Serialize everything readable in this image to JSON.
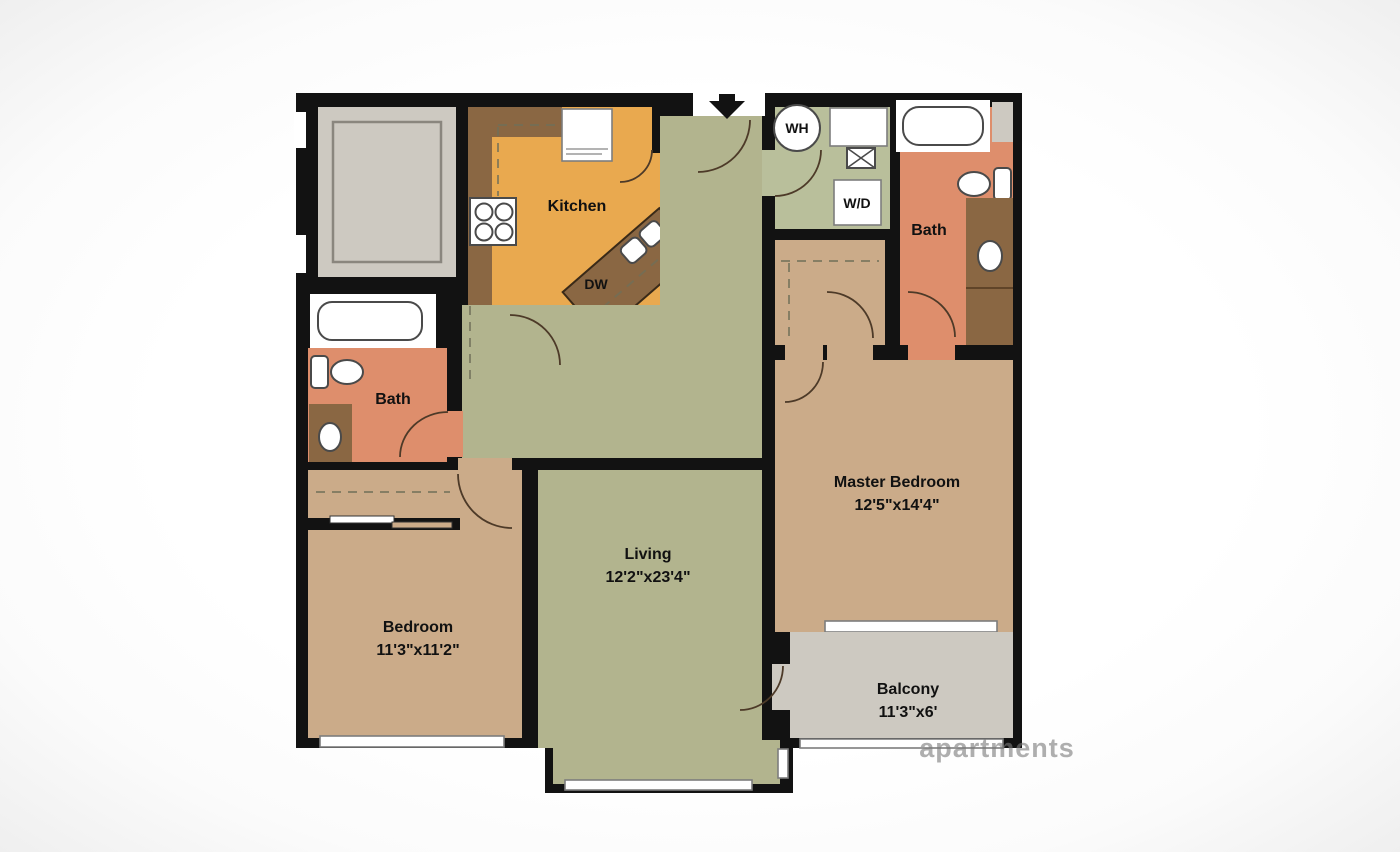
{
  "title": "Two Bedroom Apartment Floor Plan",
  "colors": {
    "wall": "#121212",
    "living": "#b2b48e",
    "laundry": "#b9bf9b",
    "bedroom": "#cbab89",
    "kitchen": "#e9a94f",
    "counter": "#8a6743",
    "bath": "#de8e6c",
    "balcony": "#cdc9c1",
    "outline": "#8a867e",
    "dash": "#6f6f58",
    "arc": "#4d3a28",
    "label": "#111111",
    "watermark": "#7a7a7a"
  },
  "rooms": {
    "kitchen": {
      "label": "Kitchen"
    },
    "living": {
      "label": "Living",
      "dims": "12'2\"x23'4\""
    },
    "master_bedroom": {
      "label": "Master Bedroom",
      "dims": "12'5\"x14'4\""
    },
    "bedroom": {
      "label": "Bedroom",
      "dims": "11'3\"x11'2\""
    },
    "balcony": {
      "label": "Balcony",
      "dims": "11'3\"x6'"
    },
    "master_bath": {
      "label": "Bath"
    },
    "bath": {
      "label": "Bath"
    }
  },
  "fixtures": {
    "dishwasher": "DW",
    "water_heater": "WH",
    "washer_dryer": "W/D"
  },
  "watermark": "apartments"
}
